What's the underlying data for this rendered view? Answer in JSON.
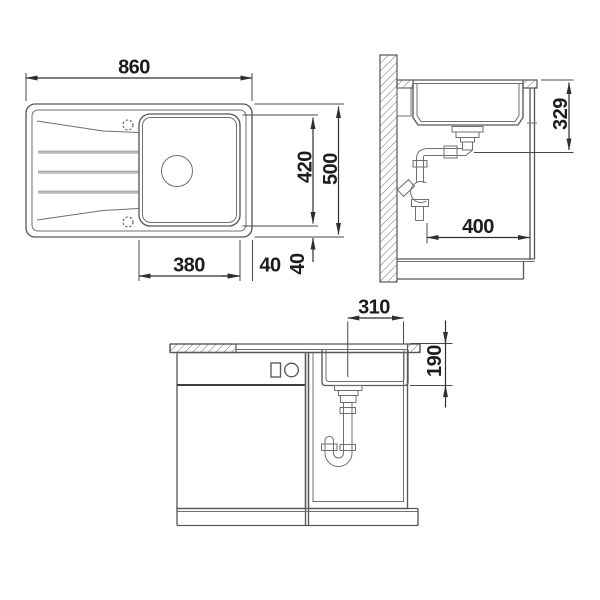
{
  "drawing_type": "sink-installation-dimension-diagram",
  "colors": {
    "background": "#ffffff",
    "line": "#585858",
    "line_light": "#6f6f6f",
    "dimension_line": "#2f2f2f",
    "dimension_text": "#1c1c1c"
  },
  "plan_view": {
    "dims": {
      "overall_width": "860",
      "overall_depth": "500",
      "bowl_length": "420",
      "bowl_width": "380",
      "side_margin": "40",
      "bottom_margin": "40"
    }
  },
  "side_view": {
    "dims": {
      "drain_height": "329",
      "wall_clearance": "400"
    }
  },
  "front_view": {
    "dims": {
      "drain_offset": "310",
      "bowl_depth": "190"
    }
  }
}
